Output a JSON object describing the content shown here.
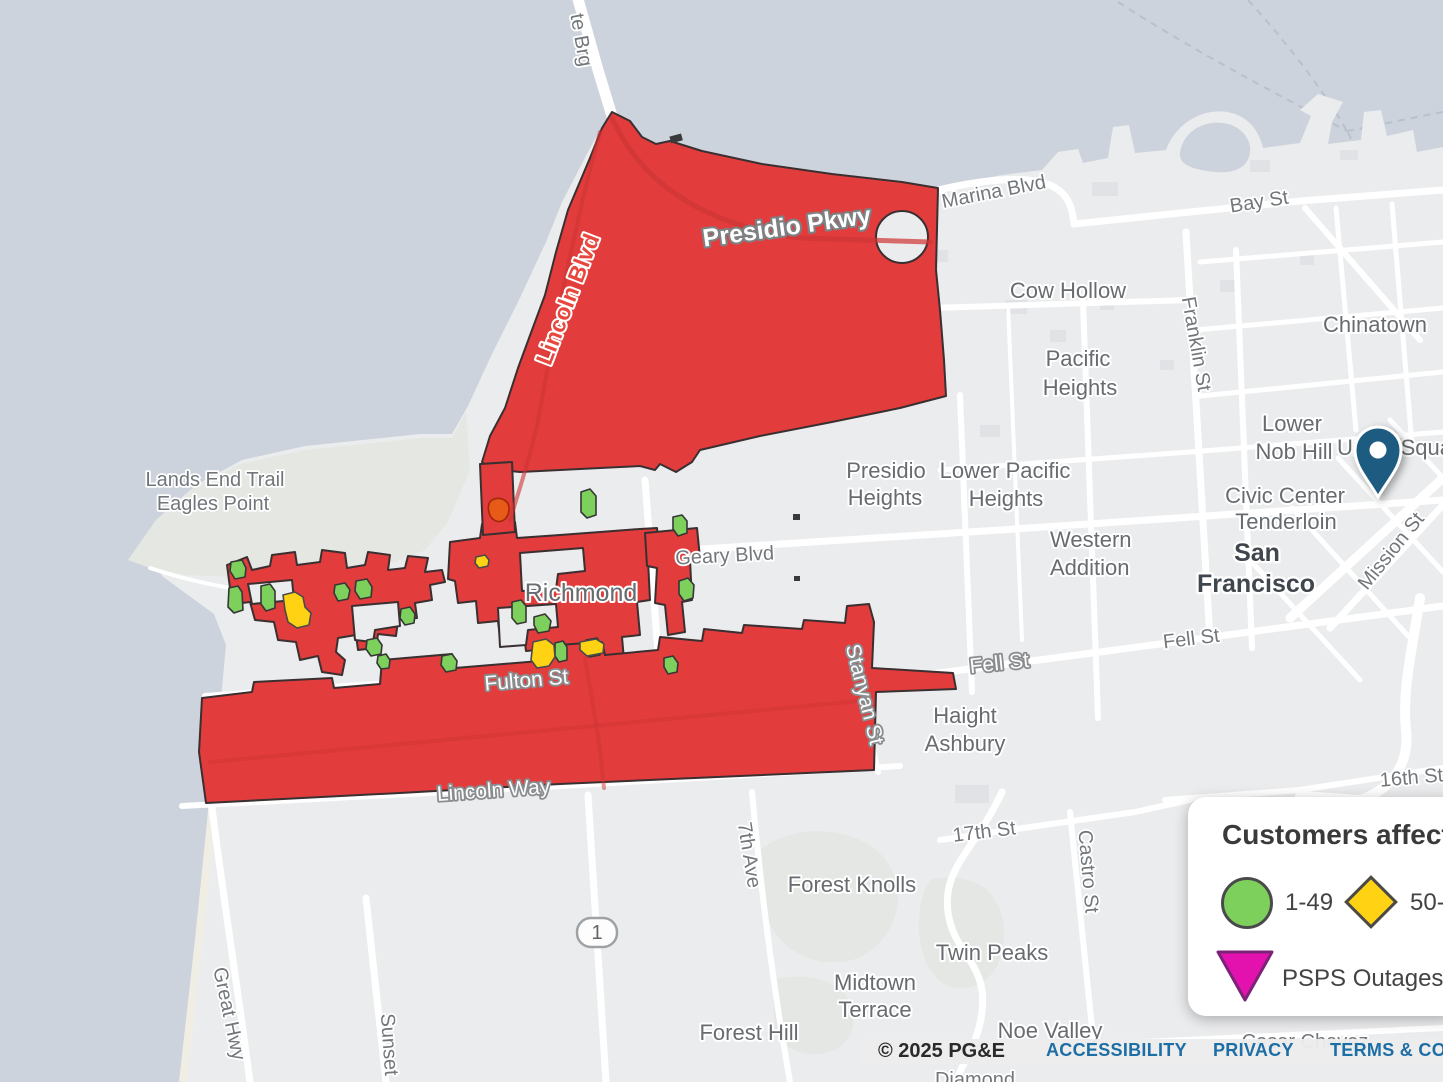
{
  "colors": {
    "water": "#cdd3dc",
    "land": "#ebeced",
    "park": "#e5e8e2",
    "road_white": "#ffffff",
    "outage_red": "#e23c3c",
    "outage_border": "#3a2f31",
    "outage_green": "#7ed05c",
    "outage_yellow": "#ffd214",
    "outage_orange": "#e85a17",
    "psps_magenta": "#e312af",
    "pin_blue": "#1d5c80",
    "link_blue": "#1e6ea6"
  },
  "map": {
    "highway_shield": "1",
    "labels": {
      "gate_brg": "te Brg",
      "marina_blvd": "Marina Blvd",
      "bay_st": "Bay St",
      "cow_hollow": "Cow Hollow",
      "pacific_1": "Pacific",
      "pacific_2": "Heights",
      "chinatown": "Chinatown",
      "franklin_st": "Franklin St",
      "lower_nob_1": "Lower",
      "lower_nob_2": "Nob Hill",
      "union_square": "Union Square",
      "civic_center": "Civic Center",
      "tenderloin": "Tenderloin",
      "city_1": "San",
      "city_2": "Francisco",
      "mission_st": "Mission St",
      "presidio_h_1": "Presidio",
      "presidio_h_2": "Heights",
      "lower_pac_1": "Lower Pacific",
      "lower_pac_2": "Heights",
      "western_1": "Western",
      "western_2": "Addition",
      "geary_blvd": "Geary Blvd",
      "richmond": "Richmond",
      "fell_st": "Fell St",
      "fulton_st": "Fulton St",
      "haight_1": "Haight",
      "haight_2": "Ashbury",
      "lincoln_way": "Lincoln Way",
      "stanyan_st": "Stanyan St",
      "st_17th": "17th St",
      "castro_st": "Castro St",
      "st_16th": "16th St",
      "ave_7th": "7th Ave",
      "forest_knolls": "Forest Knolls",
      "twin_peaks": "Twin Peaks",
      "midtown_1": "Midtown",
      "midtown_2": "Terrace",
      "forest_hill": "Forest Hill",
      "noe_valley": "Noe Valley",
      "great_hwy": "Great Hwy",
      "sunset": "Sunset",
      "lands_end": "Lands End Trail",
      "eagles_point": "Eagles Point",
      "lincoln_blvd": "Lincoln Blvd",
      "presidio_pkwy": "Presidio Pkwy",
      "cesar_chavez": "Cesar Chavez",
      "diamond": "Diamond"
    }
  },
  "legend": {
    "title": "Customers affected",
    "items": [
      {
        "shape": "circle",
        "color": "#7ed05c",
        "label": "1-49"
      },
      {
        "shape": "diamond",
        "color": "#ffd214",
        "label": "50-499"
      },
      {
        "shape": "triangle",
        "color": "#e312af",
        "label": "PSPS Outages"
      }
    ]
  },
  "footer": {
    "copyright": "© 2025 PG&E",
    "links": [
      "ACCESSIBILITY",
      "PRIVACY",
      "TERMS & CONDITIONS"
    ]
  }
}
